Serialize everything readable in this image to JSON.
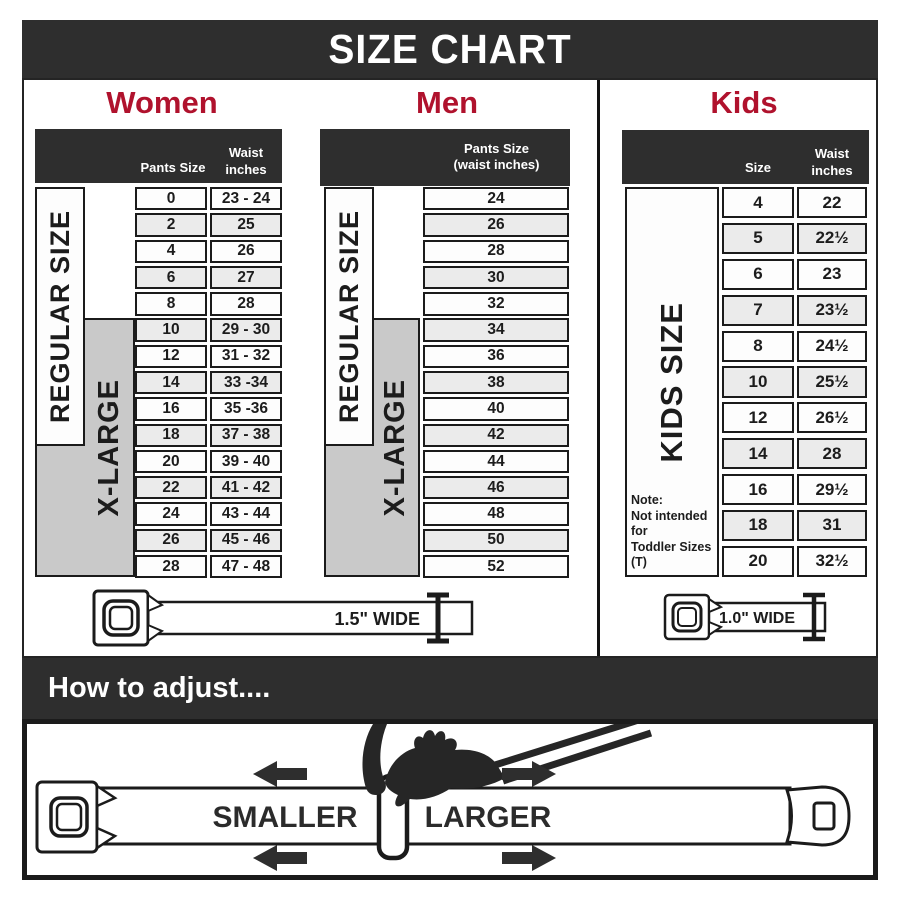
{
  "title": "SIZE CHART",
  "women": {
    "heading": "Women",
    "header": {
      "col1": "Pants Size",
      "col2": "Waist\ninches"
    },
    "regular_label": "REGULAR SIZE",
    "xlarge_label": "X-LARGE",
    "rows": [
      [
        "0",
        "23 - 24"
      ],
      [
        "2",
        "25"
      ],
      [
        "4",
        "26"
      ],
      [
        "6",
        "27"
      ],
      [
        "8",
        "28"
      ],
      [
        "10",
        "29 - 30"
      ],
      [
        "12",
        "31 - 32"
      ],
      [
        "14",
        "33 -34"
      ],
      [
        "16",
        "35 -36"
      ],
      [
        "18",
        "37 - 38"
      ],
      [
        "20",
        "39 - 40"
      ],
      [
        "22",
        "41 - 42"
      ],
      [
        "24",
        "43 - 44"
      ],
      [
        "26",
        "45 - 46"
      ],
      [
        "28",
        "47 - 48"
      ]
    ],
    "belt_label": "1.5\" WIDE"
  },
  "men": {
    "heading": "Men",
    "header": "Pants Size\n(waist inches)",
    "regular_label": "REGULAR SIZE",
    "xlarge_label": "X-LARGE",
    "rows": [
      "24",
      "26",
      "28",
      "30",
      "32",
      "34",
      "36",
      "38",
      "40",
      "42",
      "44",
      "46",
      "48",
      "50",
      "52"
    ]
  },
  "kids": {
    "heading": "Kids",
    "header": {
      "col1": "Size",
      "col2": "Waist\ninches"
    },
    "label": "KIDS SIZE",
    "note": "Note:\nNot intended for\nToddler Sizes (T)",
    "rows": [
      [
        "4",
        "22"
      ],
      [
        "5",
        "22½"
      ],
      [
        "6",
        "23"
      ],
      [
        "7",
        "23½"
      ],
      [
        "8",
        "24½"
      ],
      [
        "10",
        "25½"
      ],
      [
        "12",
        "26½"
      ],
      [
        "14",
        "28"
      ],
      [
        "16",
        "29½"
      ],
      [
        "18",
        "31"
      ],
      [
        "20",
        "32½"
      ]
    ],
    "belt_label": "1.0\" WIDE"
  },
  "adjust": {
    "heading": "How to adjust....",
    "smaller_label": "SMALLER",
    "larger_label": "LARGER"
  },
  "colors": {
    "accent_red": "#b0122d",
    "bar_dark": "#2e2e2e",
    "xlarge_gray": "#c9c9c9"
  }
}
